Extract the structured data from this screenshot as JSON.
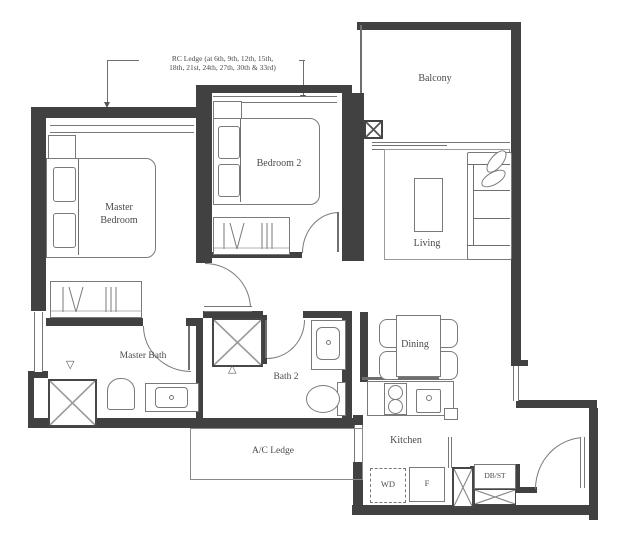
{
  "annotation": {
    "rc_line1": "RC Ledge (at 6th, 9th, 12th, 15th,",
    "rc_line2": "18th, 21st, 24th, 27th, 30th & 33rd)"
  },
  "rooms": {
    "master_bedroom": "Master Bedroom",
    "bedroom2": "Bedroom 2",
    "balcony": "Balcony",
    "living": "Living",
    "master_bath": "Master Bath",
    "bath2": "Bath 2",
    "dining": "Dining",
    "kitchen": "Kitchen",
    "ac_ledge": "A/C Ledge"
  },
  "appliances": {
    "washer": "WD",
    "fridge": "F",
    "db_st": "DB/ST"
  },
  "markers": {
    "triangle_down": "▽",
    "triangle_up": "△"
  },
  "colors": {
    "wall": "#414141",
    "line": "#7a7a7a",
    "text": "#4a4a4a",
    "background": "#ffffff"
  }
}
